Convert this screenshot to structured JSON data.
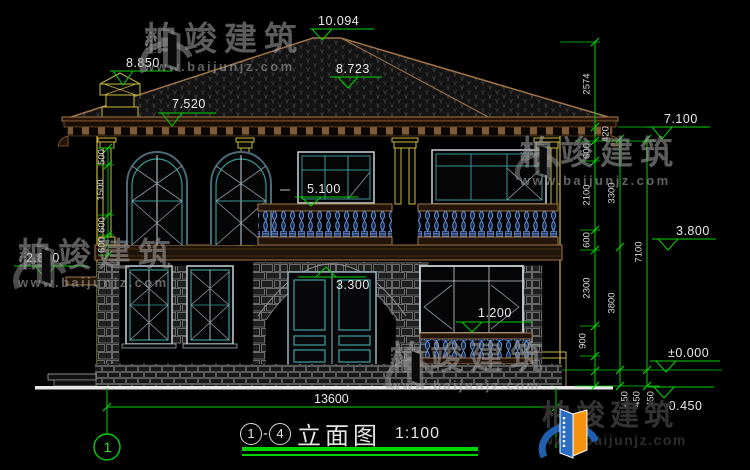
{
  "brand": {
    "name": "柏竣建筑",
    "url": "www.baijunjz.com"
  },
  "title_block": {
    "axis_from": "1",
    "axis_to": "4",
    "separator": "-",
    "drawing_name": "立面图",
    "scale": "1:100"
  },
  "axis_bubbles": {
    "left": "1"
  },
  "elevations": {
    "ridge": "10.094",
    "chimney": "8.850",
    "hip": "8.723",
    "eave": "7.520",
    "balcony_rail": "5.100",
    "left_cornice": "2.800",
    "door_arch": "3.300",
    "window_sill": "1.200",
    "right_eave": "7.100",
    "second_floor": "3.800",
    "ground": "±0.000",
    "site": "-0.450"
  },
  "dimensions": {
    "right_segments": [
      "2574",
      "420",
      "600",
      "2100",
      "600",
      "2300",
      "900"
    ],
    "ground_offsets": [
      "450",
      "450",
      "450"
    ],
    "storey_heights": [
      "3300",
      "3800"
    ],
    "total_height": "7100",
    "left_segments": [
      "500",
      "1500",
      "600",
      "600"
    ],
    "overall_width": "13600"
  },
  "colors": {
    "background": "#000000",
    "dimension_green": "#00d400",
    "outline_tan": "#a0764a",
    "trim_gold": "#c9b83d",
    "window_teal": "#3a9696",
    "baluster_blue": "#6a97e0",
    "ground_white": "#e8e8e8",
    "logo_blue": "#2a6bc4",
    "logo_orange": "#f5930f"
  }
}
